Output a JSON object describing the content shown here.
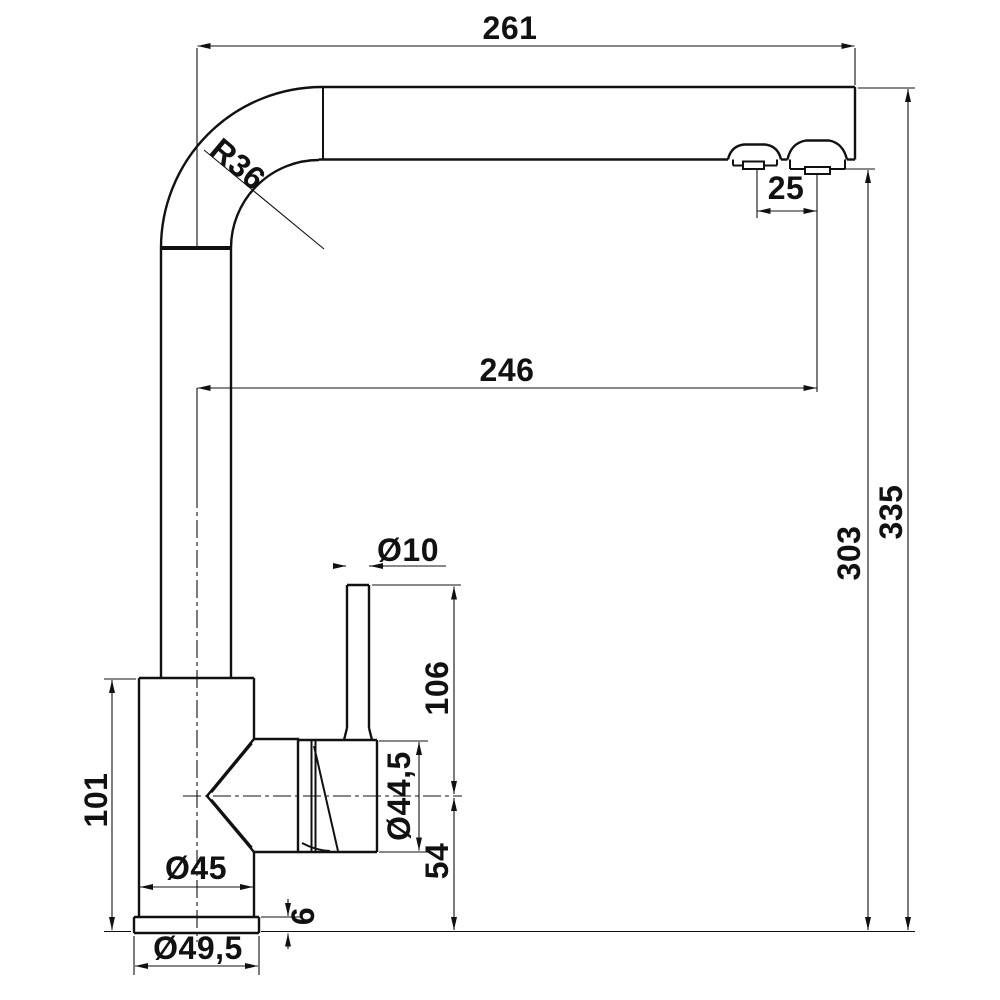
{
  "drawing": {
    "title": "faucet-dimensional-drawing",
    "colors": {
      "line": "#111111",
      "background": "#ffffff"
    },
    "dimensions": {
      "overall_width": "261",
      "spout_reach": "246",
      "outlet_spacing": "25",
      "bend_radius": "R36",
      "handle_rod_diameter": "Ø10",
      "handle_top_height": "106",
      "cartridge_housing_diameter": "Ø44,5",
      "spout_axis_height": "54",
      "body_height": "101",
      "body_diameter": "Ø45",
      "base_plate_thickness": "6",
      "base_plate_diameter": "Ø49,5",
      "outlet_clearance_height": "303",
      "overall_height": "335"
    }
  }
}
